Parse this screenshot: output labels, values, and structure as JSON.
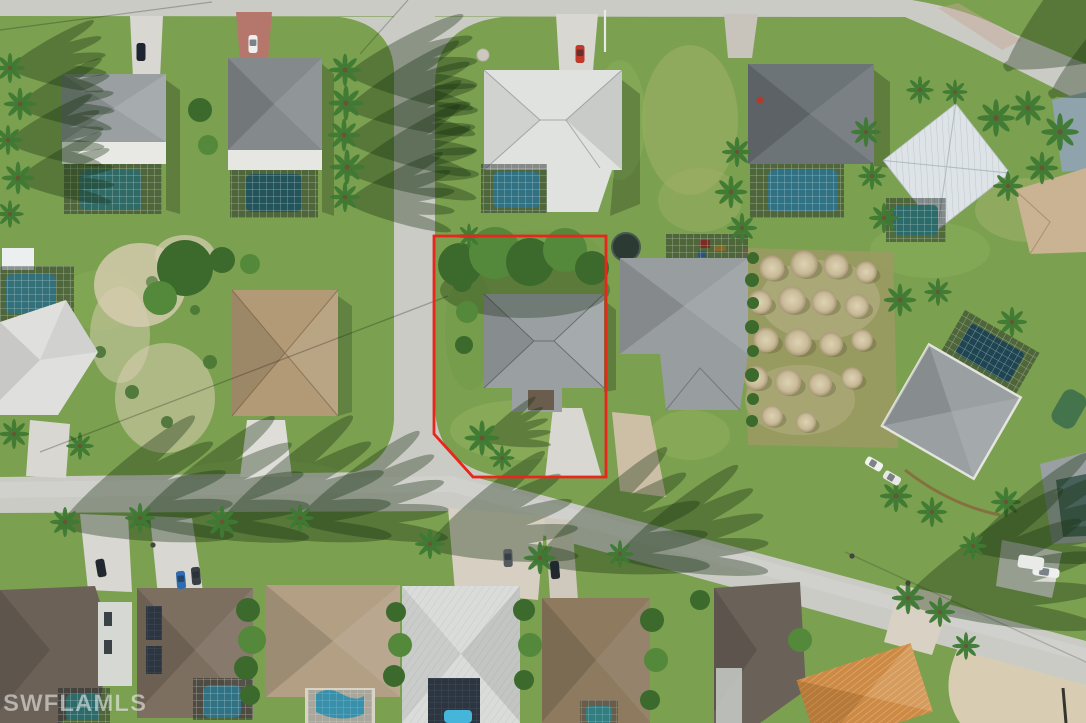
{
  "meta": {
    "type": "aerial-photo",
    "description": "Drone aerial view of a Florida residential neighborhood; a corner lot with a gray-roof house, driveway, trees and lawn is outlined in red. Surrounding lots have houses with screened pool enclosures, palm trees, a vacant sandy lot, a field of dirt mounds, and concrete streets meeting at an intersection."
  },
  "watermark": {
    "text": "SWFLAMLS"
  },
  "overlay": {
    "boundary_color": "#e8261b",
    "boundary_stroke_width": "2.8",
    "boundary_points": "434,236 606,236 606,477 473,477 434,434"
  },
  "palette": {
    "grass": "#7ba050",
    "grassLight": "#9cb96a",
    "grassDark": "#5d8a3e",
    "road": "#cbcbc6",
    "concrete": "#d8d7d1",
    "paver": "#cdbfa6",
    "paverRed": "#b5766b",
    "sand": "#d8cdb2",
    "groundDry": "#9b9a62",
    "roofGray": "#9aa0a2",
    "roofDarkGray": "#6d7478",
    "roofWhite": "#e0e2e0",
    "roofMetal": "#dde3e6",
    "roofTan": "#b3a084",
    "roofBrown": "#8d7a5f",
    "roofTaupe": "#7d6f60",
    "roofOrange": "#cd8a45",
    "poolBlue": "#45b5d9",
    "poolTeal": "#3fa9ac",
    "poolDark": "#27647d",
    "poolGreen": "#3d6f4b",
    "canopy": "#3c6a2c",
    "canopyLight": "#54883a",
    "palmGreen": "#3e7a33",
    "boundary": "#e8261b"
  },
  "scene": {
    "highlighted_lot": {
      "status": "outlined-in-red",
      "corner_lot": true,
      "features": [
        "single-family house",
        "gray hip roof",
        "concrete driveway",
        "mature trees along rear",
        "open lawn"
      ]
    },
    "context": {
      "streets": [
        "street along top edge",
        "side street running vertically",
        "main street across lower half"
      ],
      "notable": [
        "vacant sandy lot",
        "grid of dirt mounds",
        "screened pool enclosures with blue pools",
        "many palm trees with long shadows",
        "parked cars in driveways"
      ]
    }
  }
}
